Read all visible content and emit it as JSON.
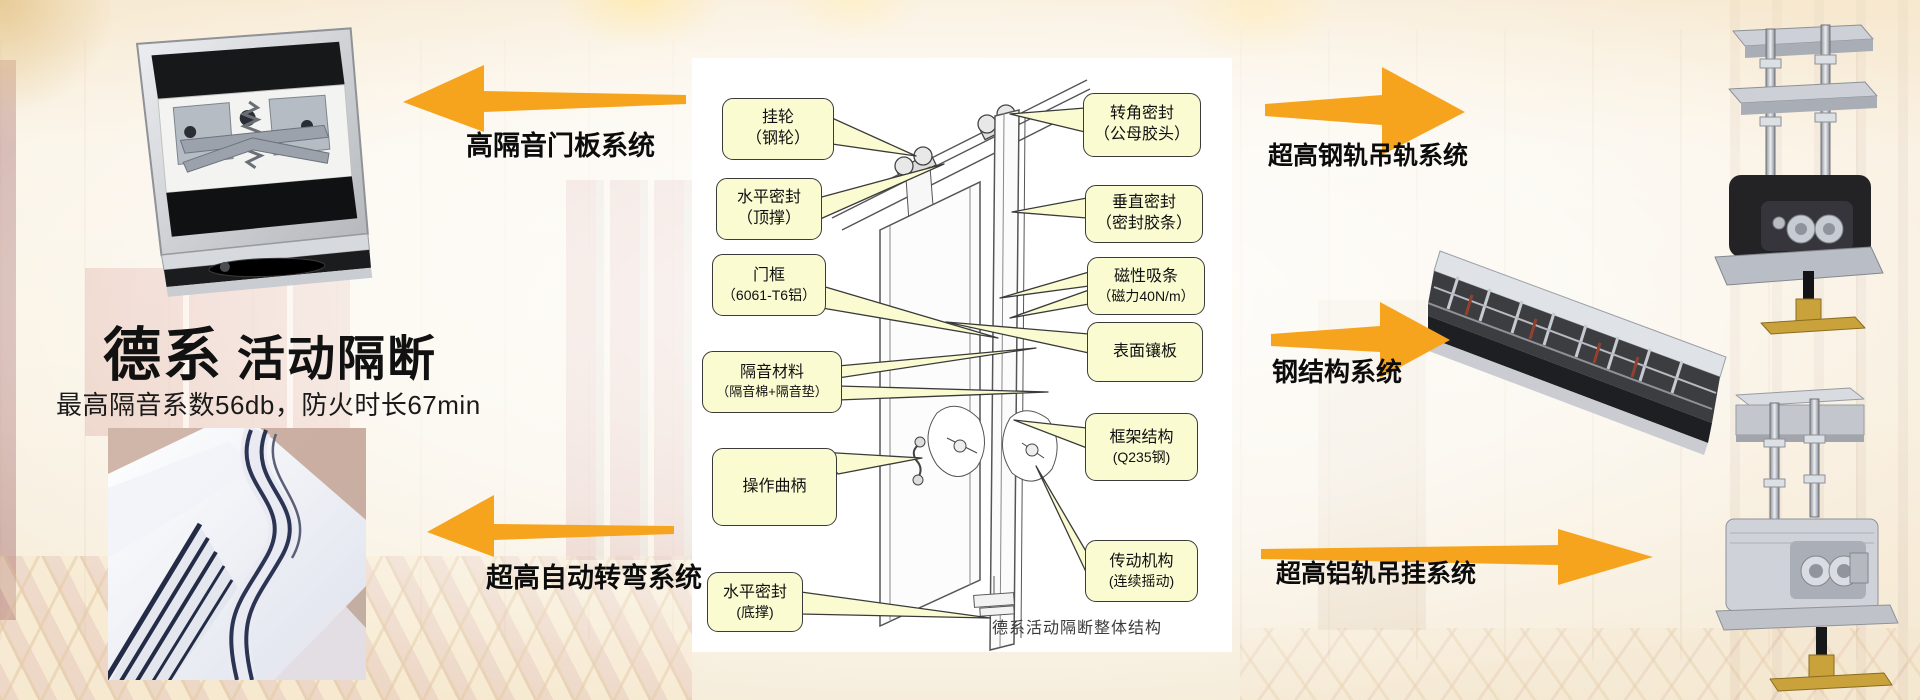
{
  "brand": {
    "title_primary": "德系",
    "title_secondary": "活动隔断",
    "subtitle": "最高隔音系数56db，防火时长67min"
  },
  "system_labels": {
    "left_top": "高隔音门板系统",
    "left_bottom": "超高自动转弯系统",
    "right_top": "超高钢轨吊轨系统",
    "right_middle": "钢结构系统",
    "right_bottom": "超高铝轨吊挂系统"
  },
  "diagram": {
    "caption": "德系活动隔断整体结构",
    "left_callouts": [
      {
        "line1": "挂轮",
        "line2": "（钢轮）"
      },
      {
        "line1": "水平密封",
        "line2": "（顶撑）"
      },
      {
        "line1": "门框",
        "line2": "（6061-T6铝）"
      },
      {
        "line1": "隔音材料",
        "line2": "（隔音棉+隔音垫）"
      },
      {
        "line1": "操作曲柄",
        "line2": ""
      },
      {
        "line1": "水平密封",
        "line2": "(底撑)"
      }
    ],
    "right_callouts": [
      {
        "line1": "转角密封",
        "line2": "（公母胶头）"
      },
      {
        "line1": "垂直密封",
        "line2": "（密封胶条）"
      },
      {
        "line1": "磁性吸条",
        "line2": "（磁力40N/m）"
      },
      {
        "line1": "表面镶板",
        "line2": ""
      },
      {
        "line1": "框架结构",
        "line2": "(Q235钢)"
      },
      {
        "line1": "传动机构",
        "line2": "(连续摇动)"
      }
    ]
  },
  "colors": {
    "accent_orange": "#F6A41E",
    "callout_fill": "#FBFBD2",
    "callout_border": "#3A3A3A",
    "panel_bg": "#FFFFFF"
  }
}
